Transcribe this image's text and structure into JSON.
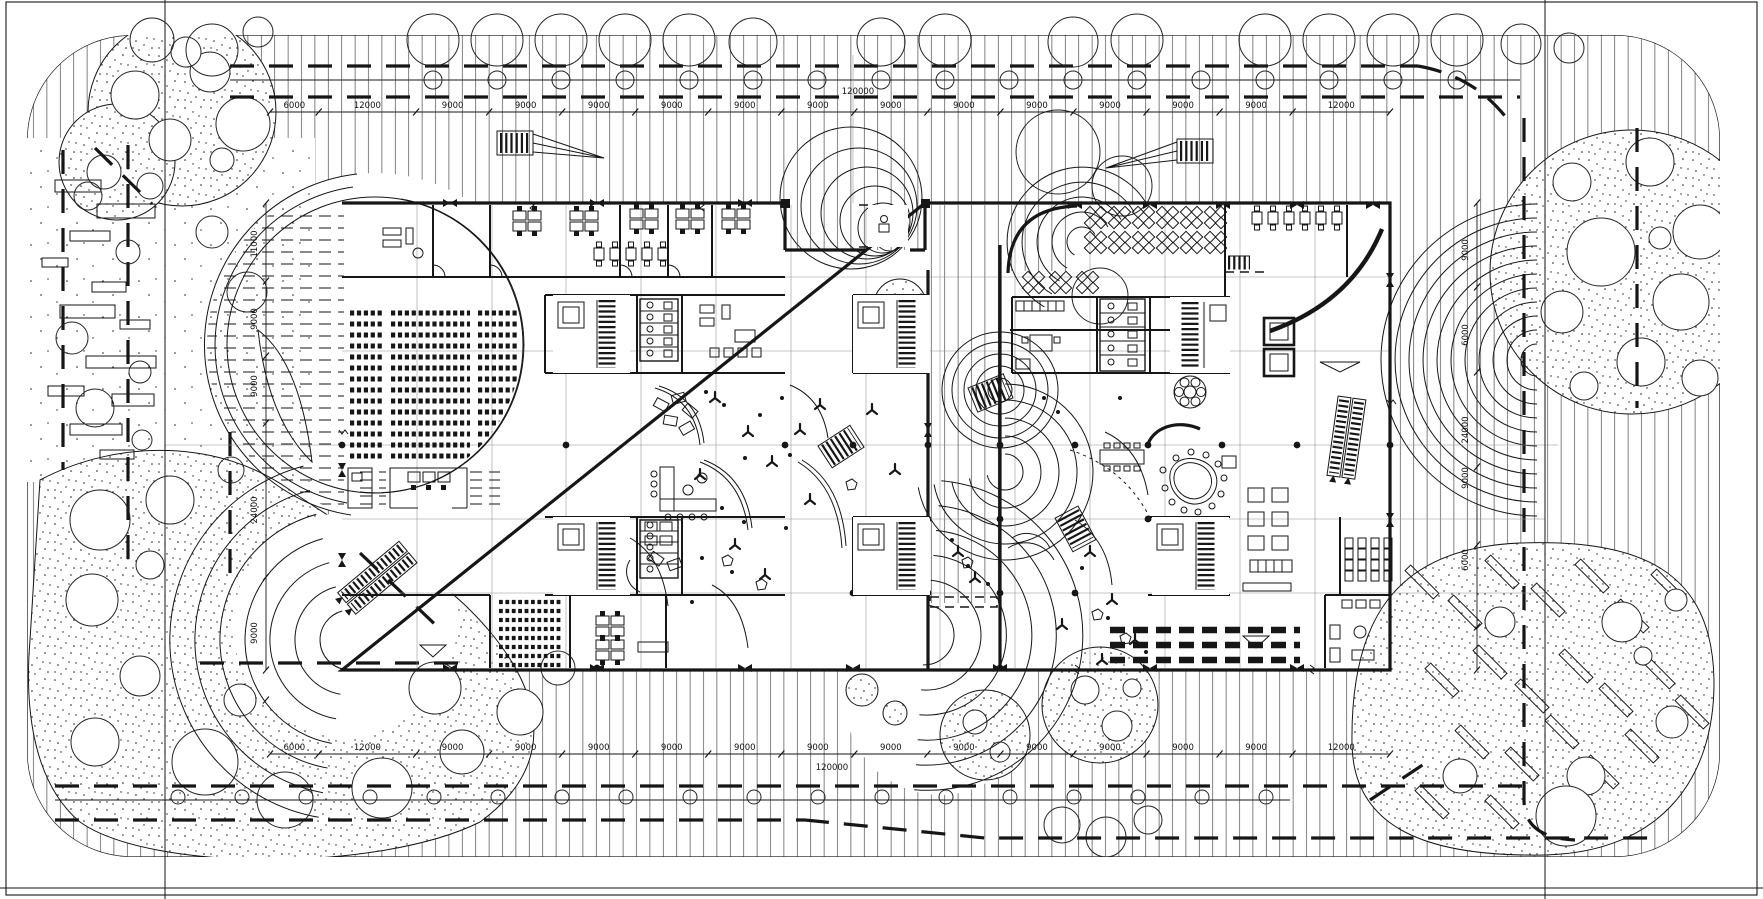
{
  "document": {
    "type": "architectural CAD site plan with ground-floor building plan",
    "style": "monochrome linework, hatched landscape, dimension chains",
    "paper_color": "#ffffff",
    "ink_color": "#161616"
  },
  "dimensions": {
    "top_chain": {
      "y": 108,
      "x_start": 270,
      "x_end": 1390,
      "segments": [
        6000,
        12000,
        9000,
        9000,
        9000,
        9000,
        9000,
        9000,
        9000,
        9000,
        9000,
        9000,
        9000,
        9000,
        12000
      ]
    },
    "top_total": {
      "text": "120000",
      "x": 858,
      "y": 94
    },
    "bottom_chain": {
      "y": 750,
      "x_start": 270,
      "x_end": 1390,
      "segments": [
        6000,
        12000,
        9000,
        9000,
        9000,
        9000,
        9000,
        9000,
        9000,
        9000,
        9000,
        9000,
        9000,
        9000,
        12000
      ]
    },
    "bottom_total": {
      "text": "120000",
      "x": 832,
      "y": 770
    },
    "left_chain": {
      "x": 257,
      "y1": 203,
      "y2": 670,
      "labels": [
        {
          "text": "11000",
          "y": 244
        },
        {
          "text": "9000",
          "y": 319
        },
        {
          "text": "9000",
          "y": 386
        },
        {
          "text": "24000",
          "y": 510
        },
        {
          "text": "9000",
          "y": 633
        }
      ]
    },
    "right_chain": {
      "x": 1468,
      "y1": 203,
      "y2": 670,
      "labels": [
        {
          "text": "9000",
          "y": 250
        },
        {
          "text": "6000",
          "y": 335
        },
        {
          "text": "24000",
          "y": 430
        },
        {
          "text": "9000",
          "y": 478
        },
        {
          "text": "6000",
          "y": 560
        }
      ]
    }
  }
}
